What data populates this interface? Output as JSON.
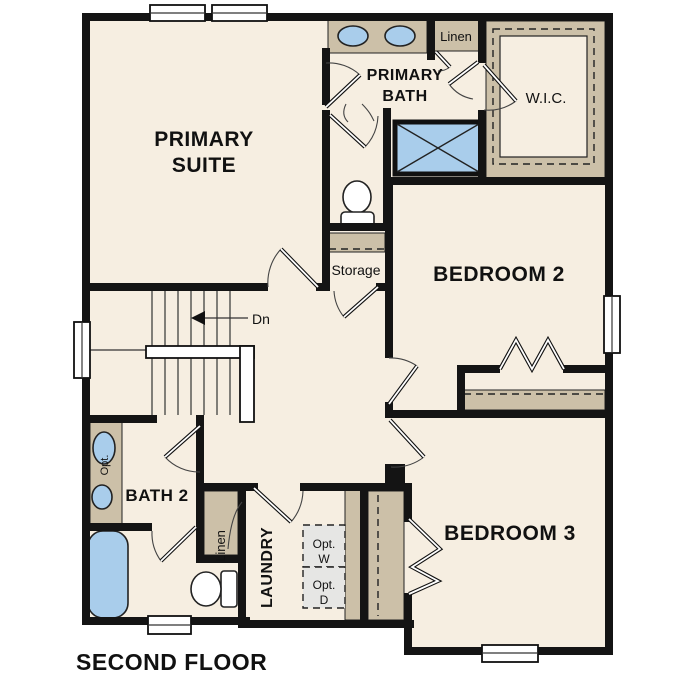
{
  "floor_plan": {
    "title": "SECOND FLOOR",
    "rooms": {
      "primary_suite": {
        "line1": "PRIMARY",
        "line2": "SUITE"
      },
      "primary_bath": {
        "line1": "PRIMARY",
        "line2": "BATH"
      },
      "wic": {
        "label": "W.I.C."
      },
      "bedroom2": {
        "label": "BEDROOM 2"
      },
      "bedroom3": {
        "label": "BEDROOM 3"
      },
      "bath2": {
        "label": "BATH 2"
      },
      "laundry": {
        "label": "LAUNDRY"
      },
      "storage": {
        "label": "Storage"
      },
      "linen_upper": {
        "label": "Linen"
      },
      "linen_lower": {
        "label": "Linen"
      }
    },
    "annotations": {
      "stairs_down": "Dn",
      "optional_washer_line1": "Opt.",
      "optional_washer_line2": "W",
      "optional_dryer_line1": "Opt.",
      "optional_dryer_line2": "D",
      "optional_sink": "Opt."
    },
    "colors": {
      "floor": "#f6eee1",
      "accent_tan": "#ccc0a8",
      "fixture_blue": "#a9cdeb",
      "optional_gray": "#e6e6e4",
      "wall": "#141414"
    }
  }
}
